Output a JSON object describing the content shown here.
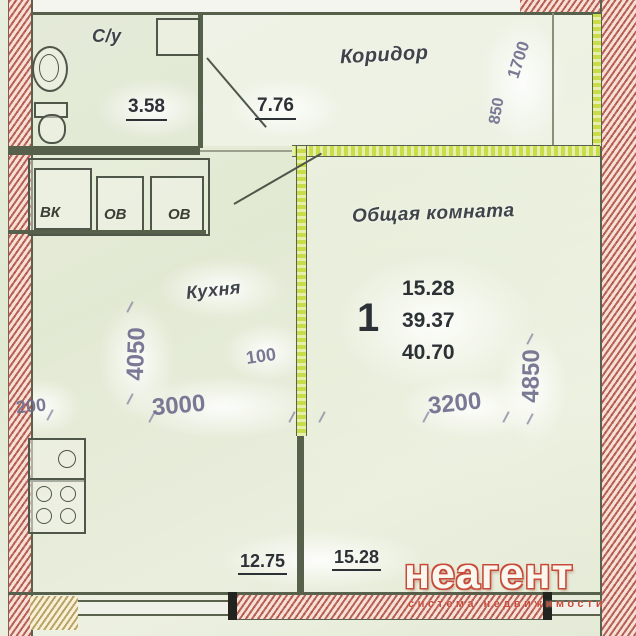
{
  "rooms": {
    "bathroom": {
      "label": "С/у",
      "area": "3.58"
    },
    "corridor": {
      "label": "Коридор",
      "area": "7.76"
    },
    "kitchen": {
      "label": "Кухня"
    },
    "living": {
      "label": "Общая комната"
    }
  },
  "shafts": {
    "s1": "ВК",
    "s2": "ОВ",
    "s3": "ОВ"
  },
  "summary": {
    "rooms_count": "1",
    "living_area": "15.28",
    "aux_area": "39.37",
    "total_area": "40.70"
  },
  "dims": {
    "d200": "200",
    "d100": "100",
    "d3000": "3000",
    "d3200": "3200",
    "d4050": "4050",
    "d4850": "4850",
    "d1700": "1700",
    "d850": "850"
  },
  "bottom_dims": {
    "left": "12.75",
    "right": "15.28"
  },
  "watermark": {
    "brand": "неагент",
    "tagline": "система недвижимости"
  },
  "colors": {
    "outer_wall_brick": "#e2ac9f",
    "interior_wall": "#57604b",
    "highlight_green": "#c9dc4a",
    "dimension_text": "#6c6c8c",
    "area_text": "#2c3136",
    "watermark_red": "#c84b3a",
    "background": "#e5ecd9"
  }
}
